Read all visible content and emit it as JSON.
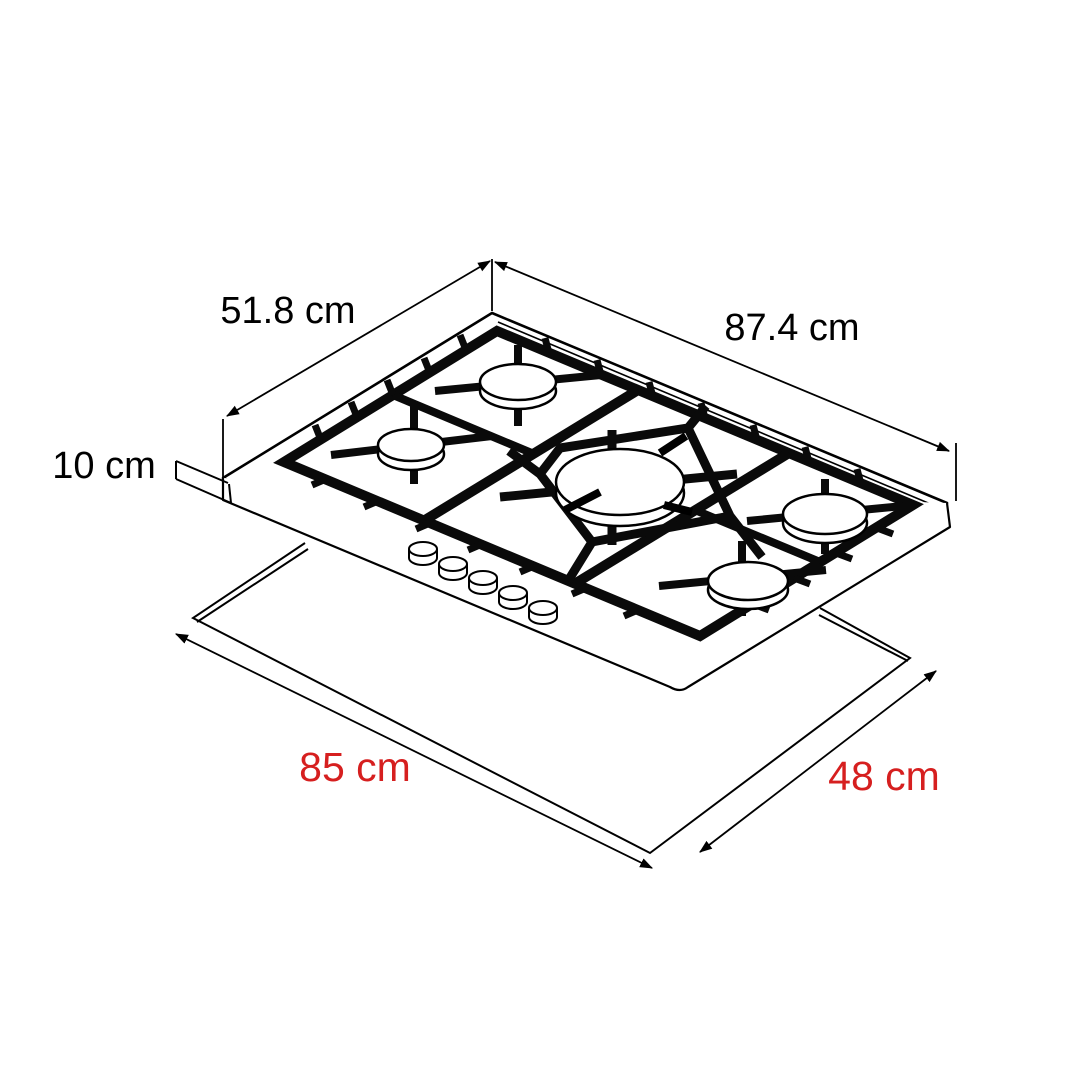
{
  "diagram": {
    "description": "Isometric technical line drawing of a 5-burner gas cooktop shown above its countertop cutout outline",
    "burner_count": 5,
    "knob_count": 5,
    "appliance_dimensions": {
      "width": "87.4 cm",
      "depth": "51.8 cm",
      "height": "10 cm"
    },
    "cutout_dimensions": {
      "width": "85 cm",
      "depth": "48 cm"
    },
    "colors": {
      "line": "#000000",
      "appliance_dim_text": "#000000",
      "cutout_dim_text": "#d61f1f",
      "background": "#ffffff"
    }
  }
}
